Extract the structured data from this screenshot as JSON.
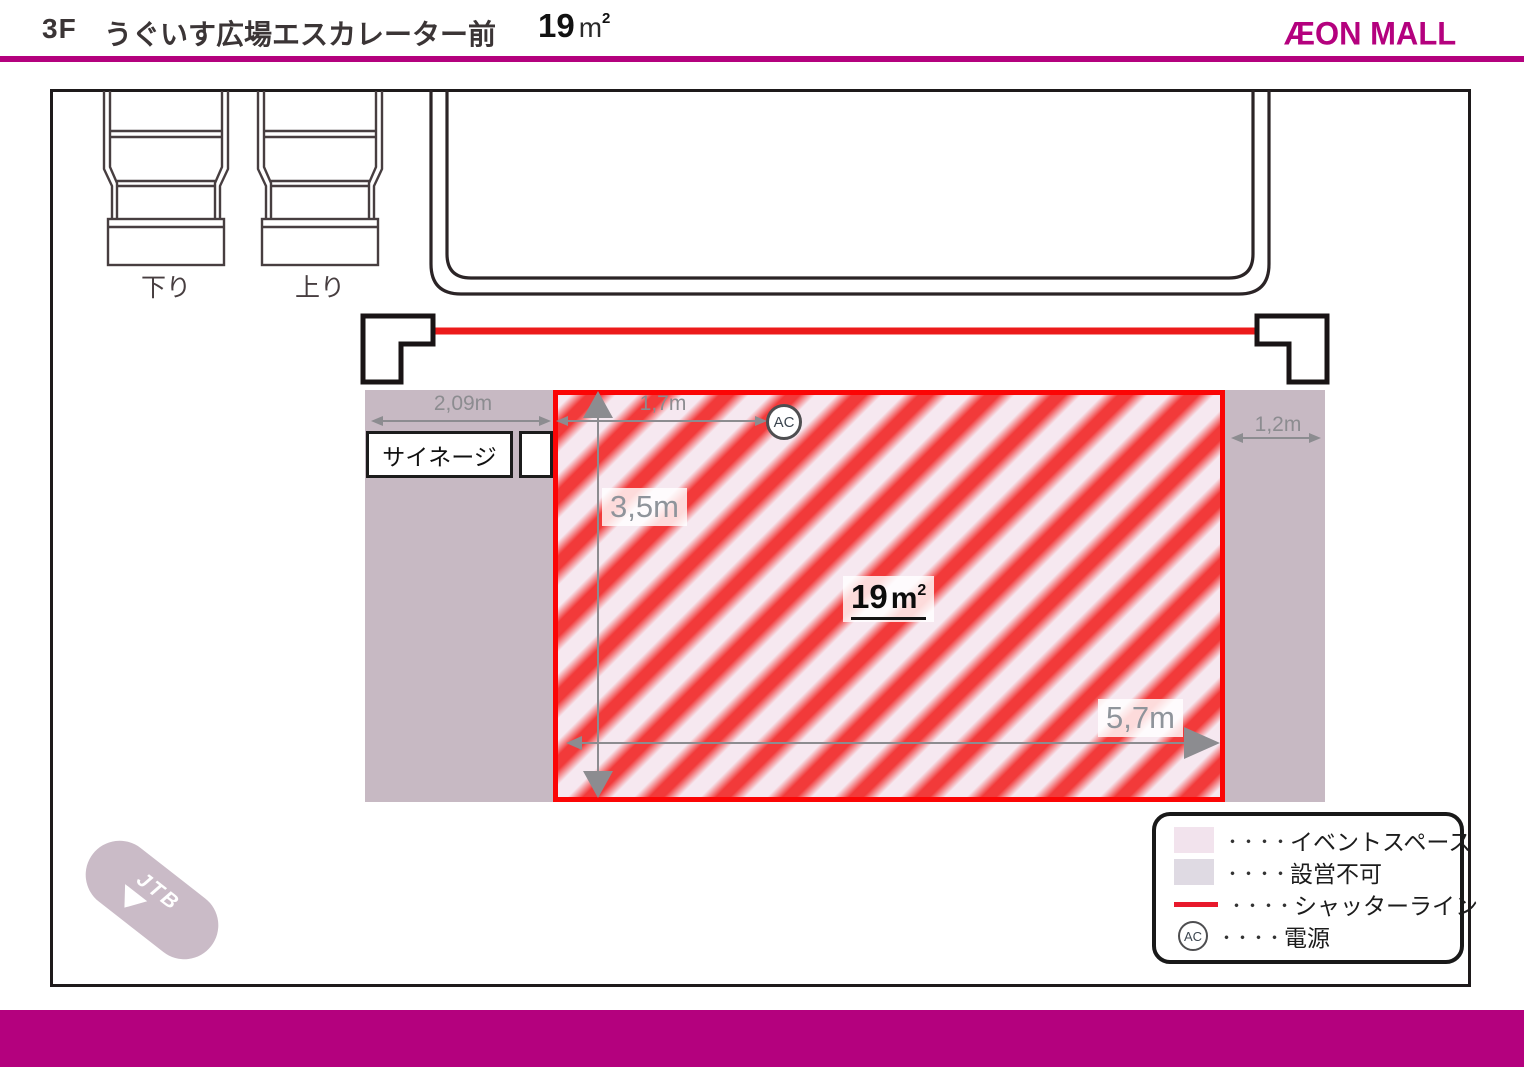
{
  "header": {
    "floor_label": "3F",
    "title": "うぐいす広場エスカレーター前",
    "area": {
      "value": "19",
      "unit": "m",
      "sup": "2"
    },
    "logo_text": "ÆON MALL"
  },
  "floorplan": {
    "escalator_down_label": "下り",
    "escalator_up_label": "上り",
    "signage_label": "サイネージ",
    "power_label": "AC",
    "area_label": {
      "value": "19",
      "unit": "m",
      "sup": "2"
    },
    "dimensions": {
      "signage_width": "2,09m",
      "top_offset": "1,7m",
      "depth": "3,5m",
      "width": "5,7m",
      "right_offset": "1,2m"
    },
    "jtb_label": "JTB"
  },
  "legend": {
    "dots": "・・・・",
    "items": [
      {
        "label": "イベントスペース",
        "swatch": "pink"
      },
      {
        "label": "設営不可",
        "swatch": "gray"
      },
      {
        "label": "シャッターライン",
        "swatch": "red-line"
      },
      {
        "label": "電源",
        "swatch": "ac"
      }
    ]
  },
  "colors": {
    "brand_magenta": "#b4017e",
    "shutter_red": "#e8192c",
    "event_border_red": "#fb0505",
    "stripe_red": "#f23a3a",
    "event_pink": "#f6e8f0",
    "no_setup_gray": "#c7b9c3",
    "legend_pink": "#f2e3ed",
    "legend_gray": "#dfdae3",
    "dim_gray": "#8c8c90",
    "jtb_mauve": "#cabbc7",
    "line_dark": "#2b2426"
  }
}
